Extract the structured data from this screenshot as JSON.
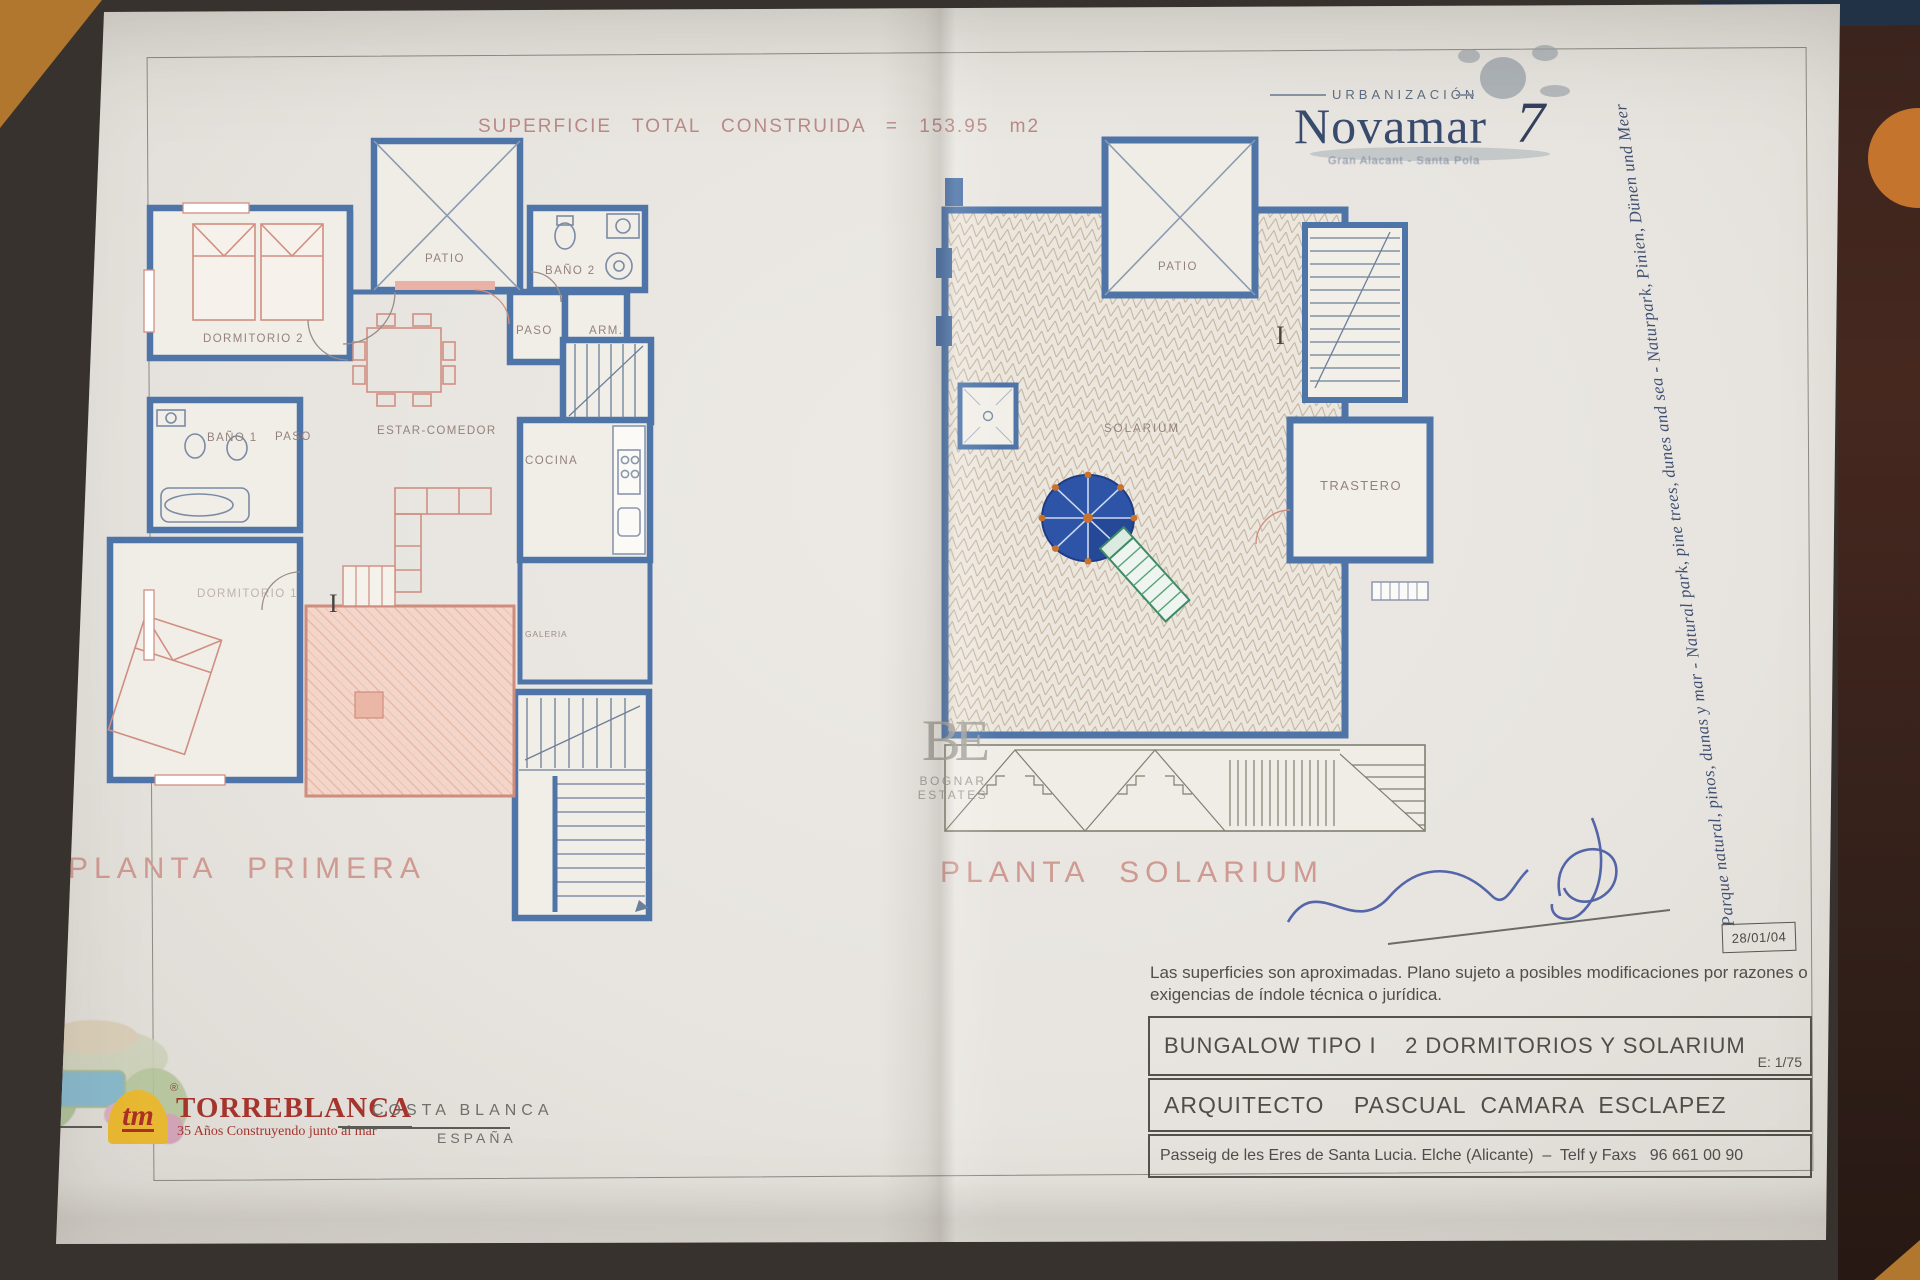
{
  "header": {
    "superficie": "SUPERFICIE TOTAL CONSTRUIDA = 153.95 m2",
    "urbanizacion": "URBANIZACIÓN",
    "brand": "Novamar",
    "brand_number": "7",
    "brand_sub": "Gran Alacant - Santa Pola",
    "motto_vertical": "Parque natural, pinos, dunas y mar  -  Natural park, pine trees, dunes and sea  -  Naturpark, Pinien, Dünen und Meer"
  },
  "plan_left": {
    "title": "PLANTA PRIMERA",
    "rooms": {
      "dormitorio2": "DORMITORIO 2",
      "patio": "PATIO",
      "bano2": "BAÑO 2",
      "paso_top": "PASO",
      "armario": "ARM.",
      "estar_comedor": "ESTAR-COMEDOR",
      "cocina": "COCINA",
      "bano1": "BAÑO 1",
      "paso_mid": "PASO",
      "dormitorio1": "DORMITORIO 1",
      "galeria": "GALERIA",
      "level_mark": "I"
    }
  },
  "plan_right": {
    "title": "PLANTA SOLARIUM",
    "rooms": {
      "patio": "PATIO",
      "solarium": "SOLARIUM",
      "trastero": "TRASTERO",
      "level_mark": "I"
    }
  },
  "watermark": {
    "monogram": "BE",
    "name": "BOGNAR ESTATES"
  },
  "titleblock": {
    "disclaimer_line1": "Las superficies son aproximadas. Plano sujeto a posibles modificaciones por razones o",
    "disclaimer_line2": "exigencias de índole técnica o jurídica.",
    "row1": "BUNGALOW TIPO I    2 DORMITORIOS Y SOLARIUM",
    "scale": "E: 1/75",
    "row2": "ARQUITECTO    PASCUAL  CAMARA  ESCLAPEZ",
    "row3": "Passeig de les Eres de Santa Lucia. Elche (Alicante)  –  Telf y Faxs   96 661 00 90",
    "date": "28/01/04"
  },
  "footer": {
    "tm": "tm",
    "registered": "®",
    "company": "TORREBLANCA",
    "tagline": "35 Años Construyendo junto al mar",
    "region": "COSTA BLANCA",
    "country": "ESPAÑA"
  },
  "colors": {
    "wall_blue": "#4e74a8",
    "furniture_salmon": "#d08f82",
    "label_gray": "#95817c",
    "title_pink": "#cf9a92",
    "brand_navy": "#3a4c6e",
    "torreblanca_red": "#a5342c",
    "tm_yellow": "#e8b832",
    "signature_ink": "#3f54a0",
    "paper": "#e9e6e1",
    "surface_dark": "#37322d",
    "surface_orange": "#b2772f"
  }
}
